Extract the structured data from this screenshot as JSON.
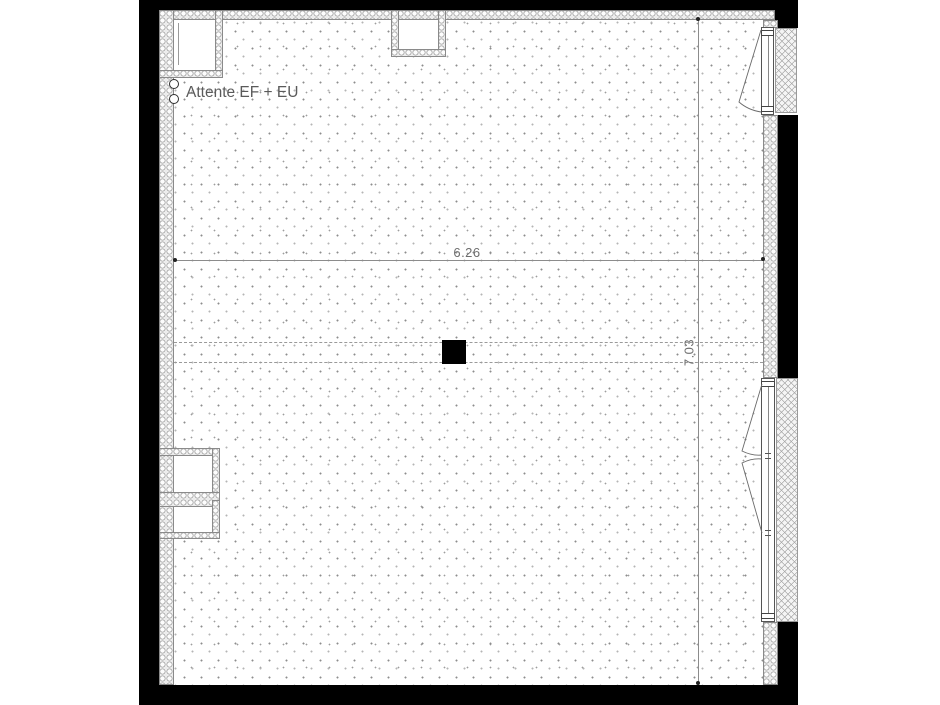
{
  "drawing": {
    "type": "architectural-floor-plan",
    "annotations": {
      "attente_label": "Attente EF + EU",
      "dim_width": "6.26",
      "dim_height": "7.03"
    },
    "colors": {
      "wall": "#000000",
      "dimension_line": "#8c8c8c",
      "dimension_text": "#6e6e6e",
      "annotation_text": "#5a5a5a",
      "center_post": "#000000"
    }
  }
}
